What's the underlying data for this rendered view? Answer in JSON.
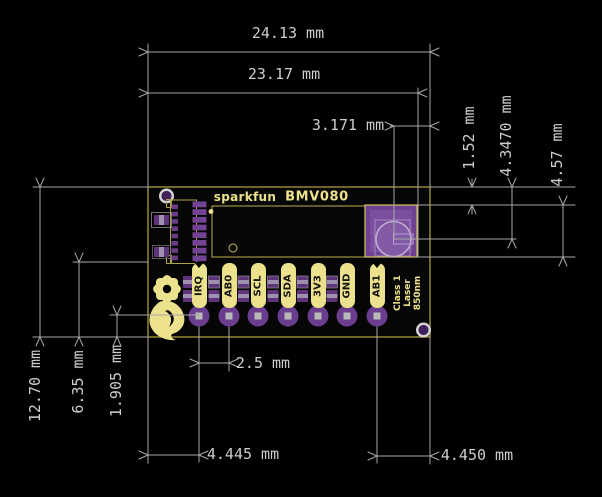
{
  "dims": {
    "board_width_outer": "24.13 mm",
    "board_width_inner": "23.17 mm",
    "sensor_center_x": "3.171 mm",
    "sensor_top_inset": "1.52 mm",
    "sensor_center_y": "4.3470 mm",
    "sensor_height": "4.57 mm",
    "board_height": "12.70 mm",
    "board_mid_height": "6.35 mm",
    "pin_row_inset": "1.905 mm",
    "pin_pitch": "2.5 mm",
    "pin_left_inset": "4.445 mm",
    "pin_right_inset": "4.450 mm"
  },
  "silkscreen": {
    "brand": "sparkfun",
    "model": "BMV080",
    "laser_line1": "Class 1",
    "laser_line2": "Laser",
    "laser_line3": "850nm",
    "pins": [
      "IRQ",
      "AB0",
      "SCL",
      "SDA",
      "3V3",
      "GND",
      "AB1"
    ]
  },
  "colors": {
    "silkscreen_yellow": "#ece18c",
    "board_outline_yellow": "#a99b3c",
    "pad_purple": "#6b3d8f",
    "sensor_purple": "#6f4291",
    "dimension_grey": "#a8a8a8",
    "background": "#000000"
  }
}
